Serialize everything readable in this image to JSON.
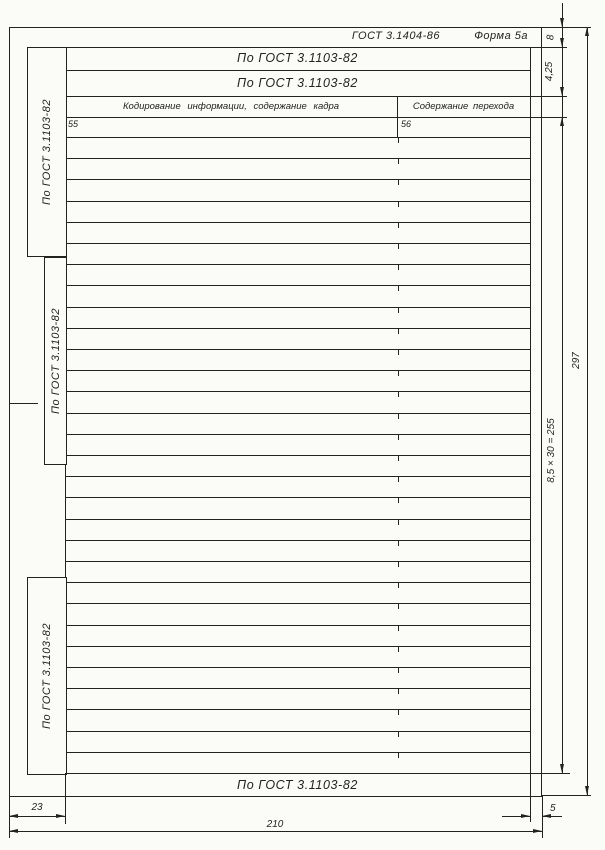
{
  "form": {
    "standard_ref": "ГОСТ 3.1404-86",
    "form_label": "Форма 5а",
    "header_row1": "По ГОСТ 3.1103-82",
    "header_row2": "По ГОСТ 3.1103-82",
    "col1_title": "Кодирование информации, содержание кадра",
    "col2_title": "Содержание перехода",
    "col1_number": "55",
    "col2_number": "56",
    "side_labels": [
      "По ГОСТ 3.1103-82",
      "По ГОСТ 3.1103-82",
      "По ГОСТ 3.1103-82"
    ],
    "footer_label": "По ГОСТ 3.1103-82",
    "row_count": 30
  },
  "dimensions": {
    "top_margin": "8",
    "header_row_height": "4,25",
    "rows_total": "8,5 × 30 = 255",
    "page_height": "297",
    "left_margin": "23",
    "page_width": "210",
    "right_margin": "5"
  },
  "colors": {
    "ink": "#222220",
    "paper": "#fbfbf8"
  }
}
